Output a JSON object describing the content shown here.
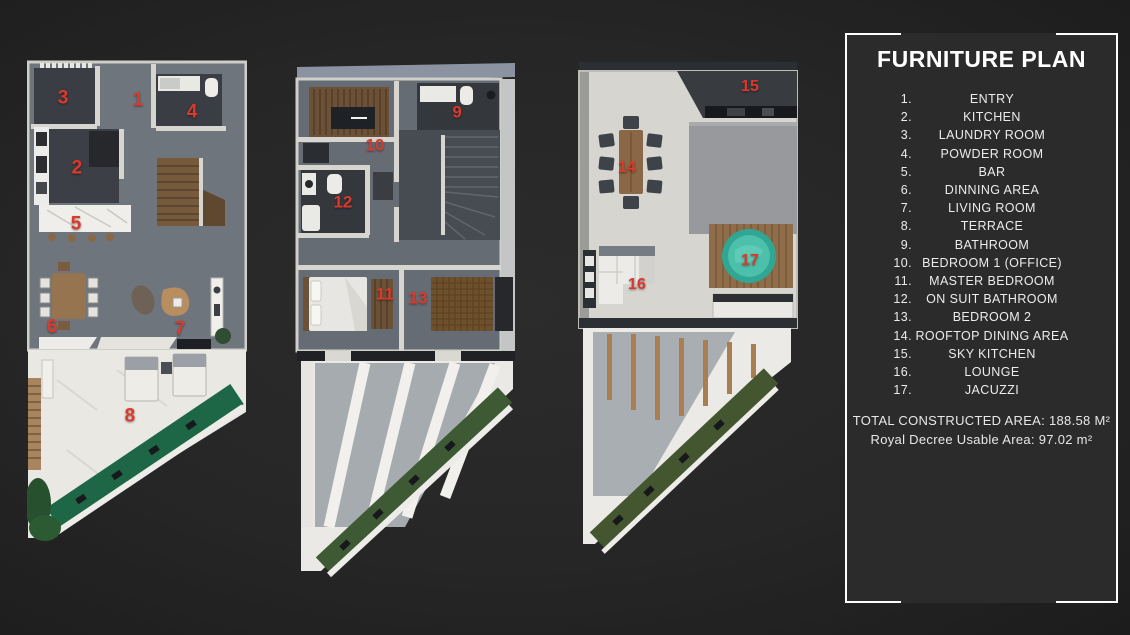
{
  "legend": {
    "title": "FURNITURE PLAN",
    "items": [
      {
        "num": "1.",
        "label": "ENTRY"
      },
      {
        "num": "2.",
        "label": "KITCHEN"
      },
      {
        "num": "3.",
        "label": "LAUNDRY ROOM"
      },
      {
        "num": "4.",
        "label": "POWDER ROOM"
      },
      {
        "num": "5.",
        "label": "BAR"
      },
      {
        "num": "6.",
        "label": "DINNING AREA"
      },
      {
        "num": "7.",
        "label": "LIVING ROOM"
      },
      {
        "num": "8.",
        "label": "TERRACE"
      },
      {
        "num": "9.",
        "label": "BATHROOM"
      },
      {
        "num": "10.",
        "label": "BEDROOM 1 (OFFICE)"
      },
      {
        "num": "11.",
        "label": "MASTER BEDROOM"
      },
      {
        "num": "12.",
        "label": "ON SUIT BATHROOM"
      },
      {
        "num": "13.",
        "label": "BEDROOM 2"
      },
      {
        "num": "14.",
        "label": "ROOFTOP DINING AREA"
      },
      {
        "num": "15.",
        "label": "SKY KITCHEN"
      },
      {
        "num": "16.",
        "label": "LOUNGE"
      },
      {
        "num": "17.",
        "label": "JACUZZI"
      }
    ],
    "total_area": "TOTAL CONSTRUCTED AREA: 188.58 M²",
    "usable_area": "Royal Decree Usable Area: 97.02 m²"
  },
  "colors": {
    "accent_red": "#DC392D",
    "hedge_green": "#1E6746",
    "roof_green": "#44562F",
    "jacuzzi_teal": "#3AB3A0",
    "panel_frame": "#FFFFFF"
  },
  "plans": [
    {
      "name": "ground-floor-plan",
      "markers": [
        {
          "n": "3",
          "x": 16.4,
          "y": 7.8
        },
        {
          "n": "1",
          "x": 50.5,
          "y": 8.2
        },
        {
          "n": "4",
          "x": 75.0,
          "y": 10.7
        },
        {
          "n": "2",
          "x": 22.7,
          "y": 22.3
        },
        {
          "n": "5",
          "x": 22.3,
          "y": 33.8
        },
        {
          "n": "6",
          "x": 11.4,
          "y": 55.1
        },
        {
          "n": "7",
          "x": 69.5,
          "y": 55.5
        },
        {
          "n": "8",
          "x": 46.8,
          "y": 73.4
        }
      ]
    },
    {
      "name": "first-floor-plan",
      "markers": [
        {
          "n": "9",
          "x": 73.0,
          "y": 10.6
        },
        {
          "n": "10",
          "x": 36.0,
          "y": 16.9
        },
        {
          "n": "12",
          "x": 21.6,
          "y": 27.9
        },
        {
          "n": "11",
          "x": 40.5,
          "y": 45.6
        },
        {
          "n": "13",
          "x": 55.4,
          "y": 46.3
        }
      ]
    },
    {
      "name": "rooftop-plan",
      "markers": [
        {
          "n": "15",
          "x": 77.9,
          "y": 5.4
        },
        {
          "n": "14",
          "x": 22.5,
          "y": 21.6
        },
        {
          "n": "17",
          "x": 77.9,
          "y": 40.2
        },
        {
          "n": "16",
          "x": 27.0,
          "y": 45.0
        }
      ]
    }
  ]
}
